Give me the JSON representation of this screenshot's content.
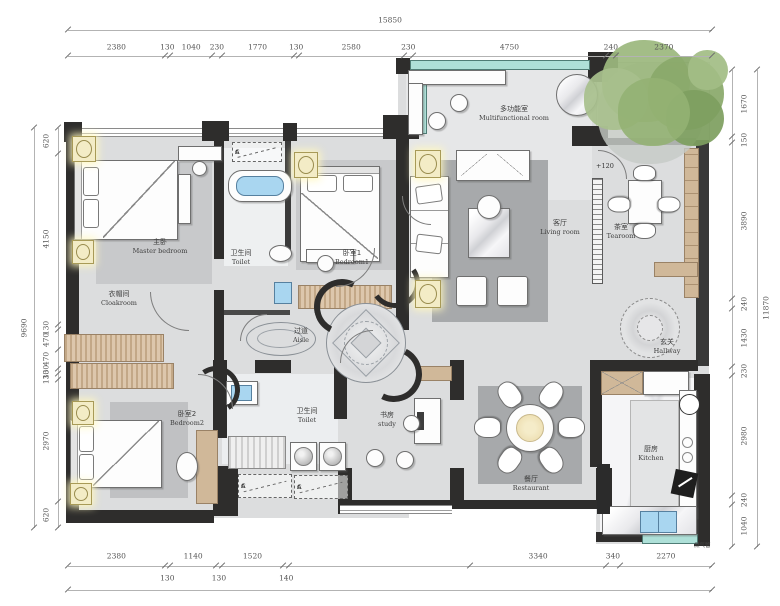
{
  "rooms": [
    {
      "id": "master-bedroom",
      "cn": "主卧",
      "en": "Master bedroom"
    },
    {
      "id": "toilet-main",
      "cn": "卫生间",
      "en": "Toilet"
    },
    {
      "id": "cloakroom",
      "cn": "衣帽间",
      "en": "Cloakroom"
    },
    {
      "id": "bedroom-1",
      "cn": "卧室1",
      "en": "Bedroom1"
    },
    {
      "id": "multifunctional-room",
      "cn": "多功能室",
      "en": "Multifunctional room"
    },
    {
      "id": "living-room",
      "cn": "客厅",
      "en": "Living room"
    },
    {
      "id": "tearoom",
      "cn": "茶室",
      "en": "Tearoom"
    },
    {
      "id": "hallway",
      "cn": "玄关",
      "en": "Hallway"
    },
    {
      "id": "aisle",
      "cn": "过道",
      "en": "Aisle"
    },
    {
      "id": "bedroom-2",
      "cn": "卧室2",
      "en": "Bedroom2"
    },
    {
      "id": "toilet-2",
      "cn": "卫生间",
      "en": "Toilet"
    },
    {
      "id": "study",
      "cn": "书房",
      "en": "study"
    },
    {
      "id": "restaurant",
      "cn": "餐厅",
      "en": "Restaurant"
    },
    {
      "id": "kitchen",
      "cn": "厨房",
      "en": "Kitchen"
    }
  ],
  "annotations": {
    "level": "+120",
    "gas_pipe": "燃气管",
    "marker_a": "A",
    "marker_c": "C"
  },
  "dimensions": {
    "top": {
      "overall": "15850",
      "segments": [
        {
          "label": "2380",
          "mm": 2380
        },
        {
          "label": "130",
          "mm": 130
        },
        {
          "label": "1040",
          "mm": 1040
        },
        {
          "label": "230",
          "mm": 230
        },
        {
          "label": "1770",
          "mm": 1770
        },
        {
          "label": "130",
          "mm": 130
        },
        {
          "label": "2580",
          "mm": 2580
        },
        {
          "label": "230",
          "mm": 230
        },
        {
          "label": "4750",
          "mm": 4750
        },
        {
          "label": "240",
          "mm": 240
        },
        {
          "label": "2370",
          "mm": 2370
        }
      ]
    },
    "bottom": {
      "segments": [
        {
          "label": "2380",
          "mm": 2380,
          "row": 1
        },
        {
          "label": "130",
          "mm": 130,
          "row": 2
        },
        {
          "label": "1140",
          "mm": 1140,
          "row": 1
        },
        {
          "label": "130",
          "mm": 130,
          "row": 2
        },
        {
          "label": "1520",
          "mm": 1520,
          "row": 1
        },
        {
          "label": "140",
          "mm": 140,
          "row": 2
        },
        {
          "label": "",
          "mm": 4460,
          "row": 0
        },
        {
          "label": "3340",
          "mm": 3340,
          "row": 1
        },
        {
          "label": "340",
          "mm": 340,
          "row": 1
        },
        {
          "label": "2270",
          "mm": 2270,
          "row": 1
        }
      ]
    },
    "left": {
      "overall": "9690",
      "segments": [
        {
          "label": "620",
          "mm": 620
        },
        {
          "label": "4150",
          "mm": 4150
        },
        {
          "label": "130",
          "mm": 130
        },
        {
          "label": "470",
          "mm": 470
        },
        {
          "label": "470",
          "mm": 470
        },
        {
          "label": "130",
          "mm": 130
        },
        {
          "label": "130",
          "mm": 130
        },
        {
          "label": "2970",
          "mm": 2970
        },
        {
          "label": "620",
          "mm": 620
        }
      ]
    },
    "right": {
      "overall": "11870",
      "segments": [
        {
          "label": "1670",
          "mm": 1670
        },
        {
          "label": "150",
          "mm": 150
        },
        {
          "label": "3890",
          "mm": 3890
        },
        {
          "label": "240",
          "mm": 240
        },
        {
          "label": "1430",
          "mm": 1430
        },
        {
          "label": "230",
          "mm": 230
        },
        {
          "label": "2980",
          "mm": 2980
        },
        {
          "label": "240",
          "mm": 240
        },
        {
          "label": "1040",
          "mm": 1040
        }
      ]
    }
  },
  "colors": {
    "wall": "#2e2d2c",
    "floor": "#dcddde",
    "rug_dark": "#a7a9ab",
    "wood": "#d0b899",
    "water_blue": "#a9d6f0",
    "glass_teal": "#aee0d8",
    "tree_green": "#8fae73",
    "lamp_yellow": "#f3ecc6"
  }
}
